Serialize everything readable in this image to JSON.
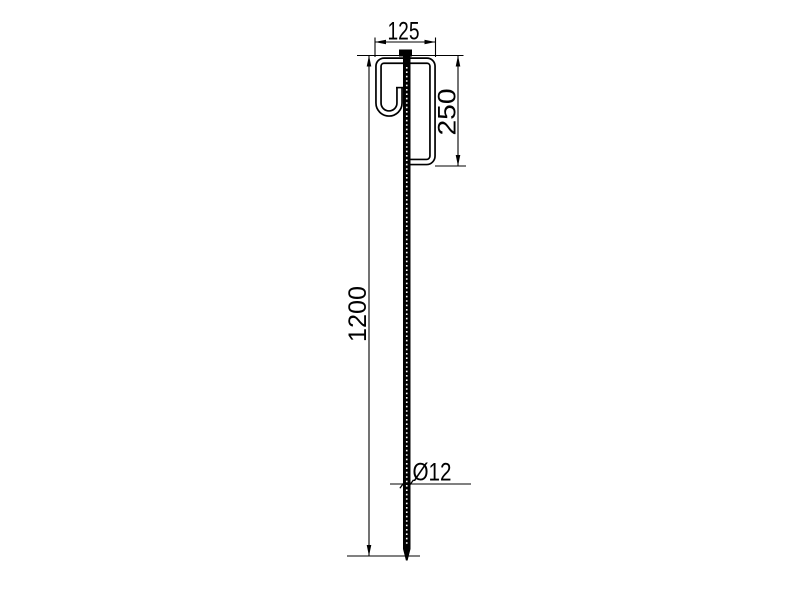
{
  "drawing": {
    "labels": {
      "top_width": "125",
      "hook_height": "250",
      "total_length": "1200",
      "diameter": "Ø12"
    },
    "colors": {
      "line": "#000000",
      "background": "#ffffff"
    }
  }
}
